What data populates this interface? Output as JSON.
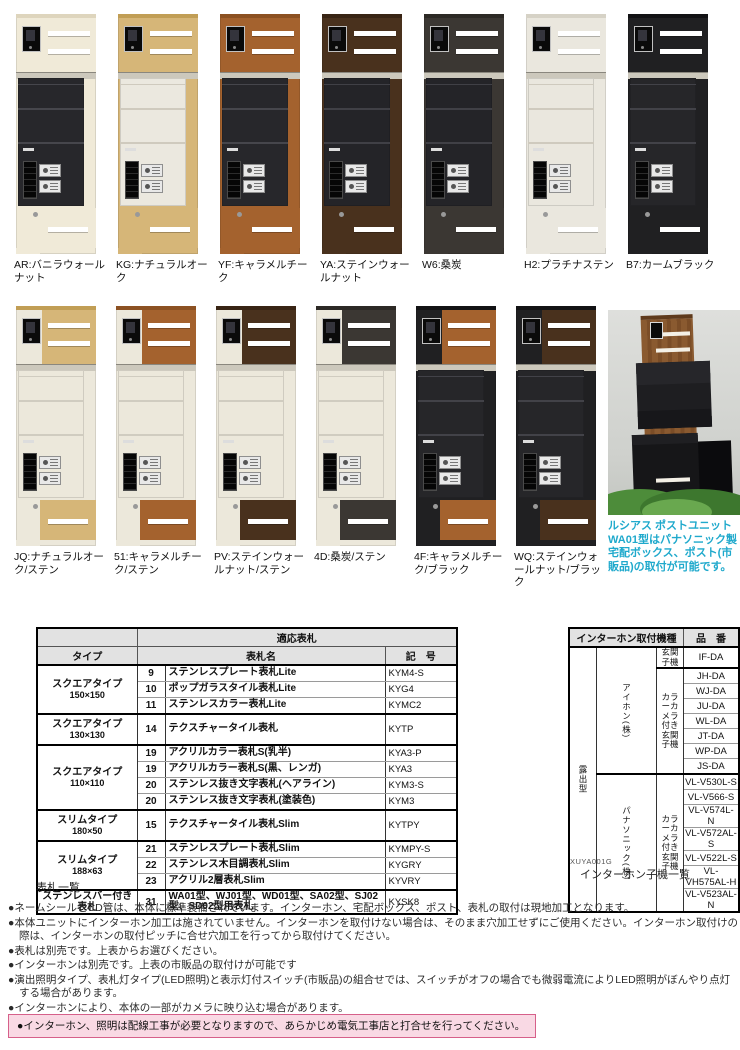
{
  "units": {
    "row1": [
      {
        "code": "AR",
        "label": "AR:バニラウォールナット",
        "colors": {
          "steel": "#f0ead8",
          "wood": "#f0ead8",
          "cap": "#ded5bd",
          "box": "#27272b",
          "line": "#46464c"
        }
      },
      {
        "code": "KG",
        "label": "KG:ナチュラルオーク",
        "colors": {
          "steel": "#d6b678",
          "wood": "#d6b678",
          "cap": "#c19e55",
          "box": "#ebe8df",
          "line": "#cfcabe"
        }
      },
      {
        "code": "YF",
        "label": "YF:キャラメルチーク",
        "colors": {
          "steel": "#a4622e",
          "wood": "#a4622e",
          "cap": "#8c5122",
          "box": "#27272b",
          "line": "#46464c"
        }
      },
      {
        "code": "YA",
        "label": "YA:ステインウォールナット",
        "colors": {
          "steel": "#49311d",
          "wood": "#49311d",
          "cap": "#382414",
          "box": "#242428",
          "line": "#404046"
        }
      },
      {
        "code": "W6",
        "label": "W6:桑炭",
        "colors": {
          "steel": "#3b3733",
          "wood": "#3b3733",
          "cap": "#2c2925",
          "box": "#242428",
          "line": "#404046"
        }
      },
      {
        "code": "H2",
        "label": "H2:プラチナステン",
        "colors": {
          "steel": "#eae7de",
          "wood": "#eae7de",
          "cap": "#d6d2c6",
          "box": "#eae7de",
          "line": "#cfcabe"
        }
      },
      {
        "code": "B7",
        "label": "B7:カームブラック",
        "colors": {
          "steel": "#202022",
          "wood": "#202022",
          "cap": "#121214",
          "box": "#262629",
          "line": "#424248"
        }
      }
    ],
    "row2": [
      {
        "code": "JQ",
        "label": "JQ:ナチュラルオーク/ステン",
        "colors": {
          "steel": "#ece8db",
          "wood": "#d6b678",
          "cap": "#c19e55",
          "box": "#ece8db",
          "line": "#d0ccc0"
        }
      },
      {
        "code": "51",
        "label": "51:キャラメルチーク/ステン",
        "colors": {
          "steel": "#ece8db",
          "wood": "#a4622e",
          "cap": "#8c5122",
          "box": "#ece8db",
          "line": "#d0ccc0"
        }
      },
      {
        "code": "PV",
        "label": "PV:ステインウォールナット/ステン",
        "colors": {
          "steel": "#ece8db",
          "wood": "#49311d",
          "cap": "#382414",
          "box": "#ece8db",
          "line": "#d0ccc0"
        }
      },
      {
        "code": "4D",
        "label": "4D:桑炭/ステン",
        "colors": {
          "steel": "#ece8db",
          "wood": "#3b3733",
          "cap": "#2c2925",
          "box": "#ece8db",
          "line": "#d0ccc0"
        }
      },
      {
        "code": "4F",
        "label": "4F:キャラメルチーク/ブラック",
        "colors": {
          "steel": "#202022",
          "wood": "#a4622e",
          "cap": "#121214",
          "box": "#262629",
          "line": "#424248"
        }
      },
      {
        "code": "WQ",
        "label": "WQ:ステインウォールナット/ブラック",
        "colors": {
          "steel": "#202022",
          "wood": "#49311d",
          "cap": "#121214",
          "box": "#262629",
          "line": "#424248"
        }
      }
    ],
    "photo": {
      "caption": "ルシアス ポストユニットWA01型はパナソニック製宅配ボックス、ポスト(市販品)の取付が可能です。",
      "colors": {
        "capcol": "#1fa9cc"
      }
    }
  },
  "nameplate_table": {
    "caption": "表札一覧",
    "span_header": "適応表札",
    "headers": {
      "type": "タイプ",
      "name": "表札名",
      "code": "記　号"
    },
    "groups": [
      {
        "type": "スクエアタイプ",
        "size": "150×150",
        "rows": [
          {
            "no": "9",
            "name": "ステンレスプレート表札Lite",
            "code": "KYM4-S"
          },
          {
            "no": "10",
            "name": "ポップガラスタイル表札Lite",
            "code": "KYG4"
          },
          {
            "no": "11",
            "name": "ステンレスカラー表札Lite",
            "code": "KYMC2"
          }
        ]
      },
      {
        "type": "スクエアタイプ",
        "size": "130×130",
        "rows": [
          {
            "no": "14",
            "name": "テクスチャータイル表札",
            "code": "KYTP"
          }
        ]
      },
      {
        "type": "スクエアタイプ",
        "size": "110×110",
        "rows": [
          {
            "no": "19",
            "name": "アクリルカラー表札S(乳半)",
            "code": "KYA3-P"
          },
          {
            "no": "19",
            "name": "アクリルカラー表札S(黒、レンガ)",
            "code": "KYA3"
          },
          {
            "no": "20",
            "name": "ステンレス抜き文字表札(ヘアライン)",
            "code": "KYM3-S"
          },
          {
            "no": "20",
            "name": "ステンレス抜き文字表札(塗装色)",
            "code": "KYM3"
          }
        ]
      },
      {
        "type": "スリムタイプ",
        "size": "180×50",
        "rows": [
          {
            "no": "15",
            "name": "テクスチャータイル表札Slim",
            "code": "KYTPY"
          }
        ]
      },
      {
        "type": "スリムタイプ",
        "size": "188×63",
        "rows": [
          {
            "no": "21",
            "name": "ステンレスプレート表札Slim",
            "code": "KYMPY-S"
          },
          {
            "no": "22",
            "name": "ステンレス木目調表札Slim",
            "code": "KYGRY"
          },
          {
            "no": "23",
            "name": "アクリル2層表札Slim",
            "code": "KYVRY"
          }
        ]
      },
      {
        "type": "ステンレスバー付き表札",
        "size": "",
        "rows": [
          {
            "no": "31",
            "name": "WA01型、WJ01型、WD01型、SA02型、SJ02型、SD02型用表札",
            "code": "KYSK8"
          }
        ]
      }
    ]
  },
  "intercom_table": {
    "caption": "インターホン子機一覧",
    "ref_code": "XUYA001G",
    "header_left": "インターホン取付機種",
    "header_right": "品　番",
    "mount_type": "露出型",
    "makers": [
      {
        "name": "アイホン(株)",
        "groups": [
          {
            "type": "玄関子機",
            "models": [
              "IF-DA"
            ]
          },
          {
            "type": "カラーカメラ付き玄関子機",
            "models": [
              "JH-DA",
              "WJ-DA",
              "JU-DA",
              "WL-DA",
              "JT-DA",
              "WP-DA",
              "JS-DA"
            ]
          }
        ]
      },
      {
        "name": "パナソニック(株)",
        "groups": [
          {
            "type": "カラーカメラ付き玄関子機",
            "models": [
              "VL-V530L-S",
              "VL-V566-S",
              "VL-V574L-N",
              "VL-V572AL-S",
              "VL-V522L-S",
              "VL-VH575AL-H",
              "VL-V523AL-N"
            ]
          }
        ]
      }
    ]
  },
  "notes": [
    "●ネームシールとCD管は、本体に標準装備されています。インターホン、宅配ボックス、ポスト、表札の取付は現地加工となります。",
    "●本体ユニットにインターホン加工は施されていません。インターホンを取付けない場合は、そのまま穴加工せずにご使用ください。インターホン取付けの際は、インターホンの取付ピッチに合せ穴加工を行ってから取付けてください。",
    "●表札は別売です。上表からお選びください。",
    "●インターホンは別売です。上表の市販品の取付けが可能です",
    "●演出照明タイプ、表札灯タイプ(LED照明)と表示灯付スイッチ(市販品)の組合せでは、スイッチがオフの場合でも微弱電流によりLED照明がぼんやり点灯する場合があります。",
    "●インターホンにより、本体の一部がカメラに映り込む場合があります。"
  ],
  "warning": "●インターホン、照明は配線工事が必要となりますので、あらかじめ電気工事店と打合せを行ってください。"
}
